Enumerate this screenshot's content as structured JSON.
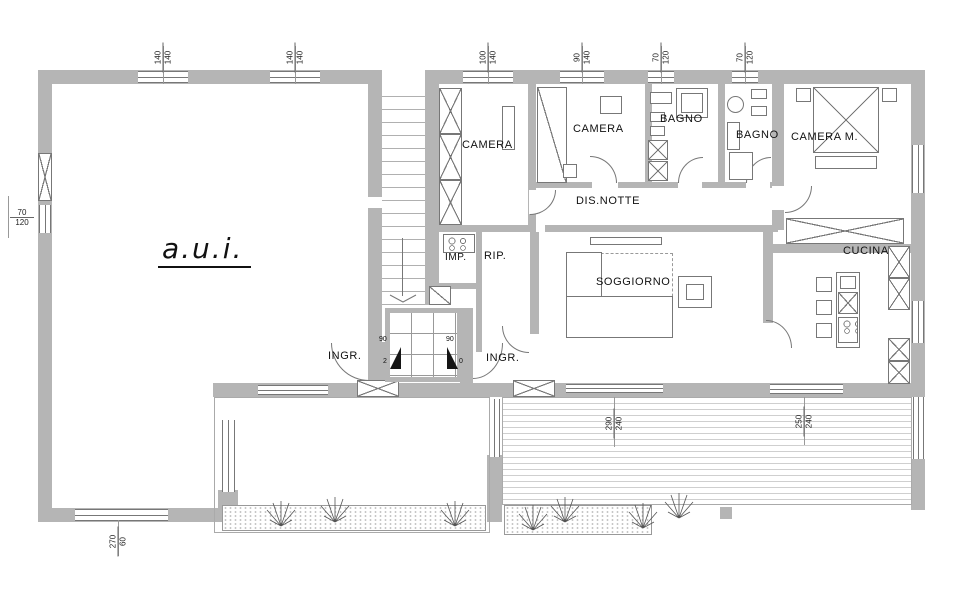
{
  "plan": {
    "rooms": {
      "aui": "a.u.i.",
      "camera1": "CAMERA",
      "camera2": "CAMERA",
      "bagno1": "BAGNO",
      "bagno2": "BAGNO",
      "camera_m": "CAMERA M.",
      "dis_notte": "DIS.NOTTE",
      "imp": "IMP.",
      "rip": "RIP.",
      "soggiorno": "SOGGIORNO",
      "cucina": "CUCINA",
      "ingr_left": "INGR.",
      "ingr_right": "INGR."
    },
    "dimensions": {
      "aui_top_win1": {
        "w": "140",
        "h": "140"
      },
      "aui_top_win2": {
        "w": "140",
        "h": "140"
      },
      "apt_top_win1": {
        "w": "100",
        "h": "140"
      },
      "apt_top_win2": {
        "w": "90",
        "h": "140"
      },
      "apt_top_win3": {
        "w": "70",
        "h": "120"
      },
      "apt_top_win4": {
        "w": "70",
        "h": "120"
      },
      "aui_left_win": {
        "w": "70",
        "h": "120"
      },
      "aui_bottom_win": {
        "w": "270",
        "h": "60"
      },
      "terrace_left": {
        "w": "290",
        "h": "240"
      },
      "terrace_right": {
        "w": "250",
        "h": "240"
      },
      "entry_door_left": {
        "w": "90",
        "h": "2"
      },
      "entry_door_right": {
        "w": "90",
        "h": "0"
      }
    },
    "colors": {
      "wall": "#b5b5b5",
      "line": "#777777",
      "text": "#111111",
      "background": "#ffffff"
    }
  }
}
